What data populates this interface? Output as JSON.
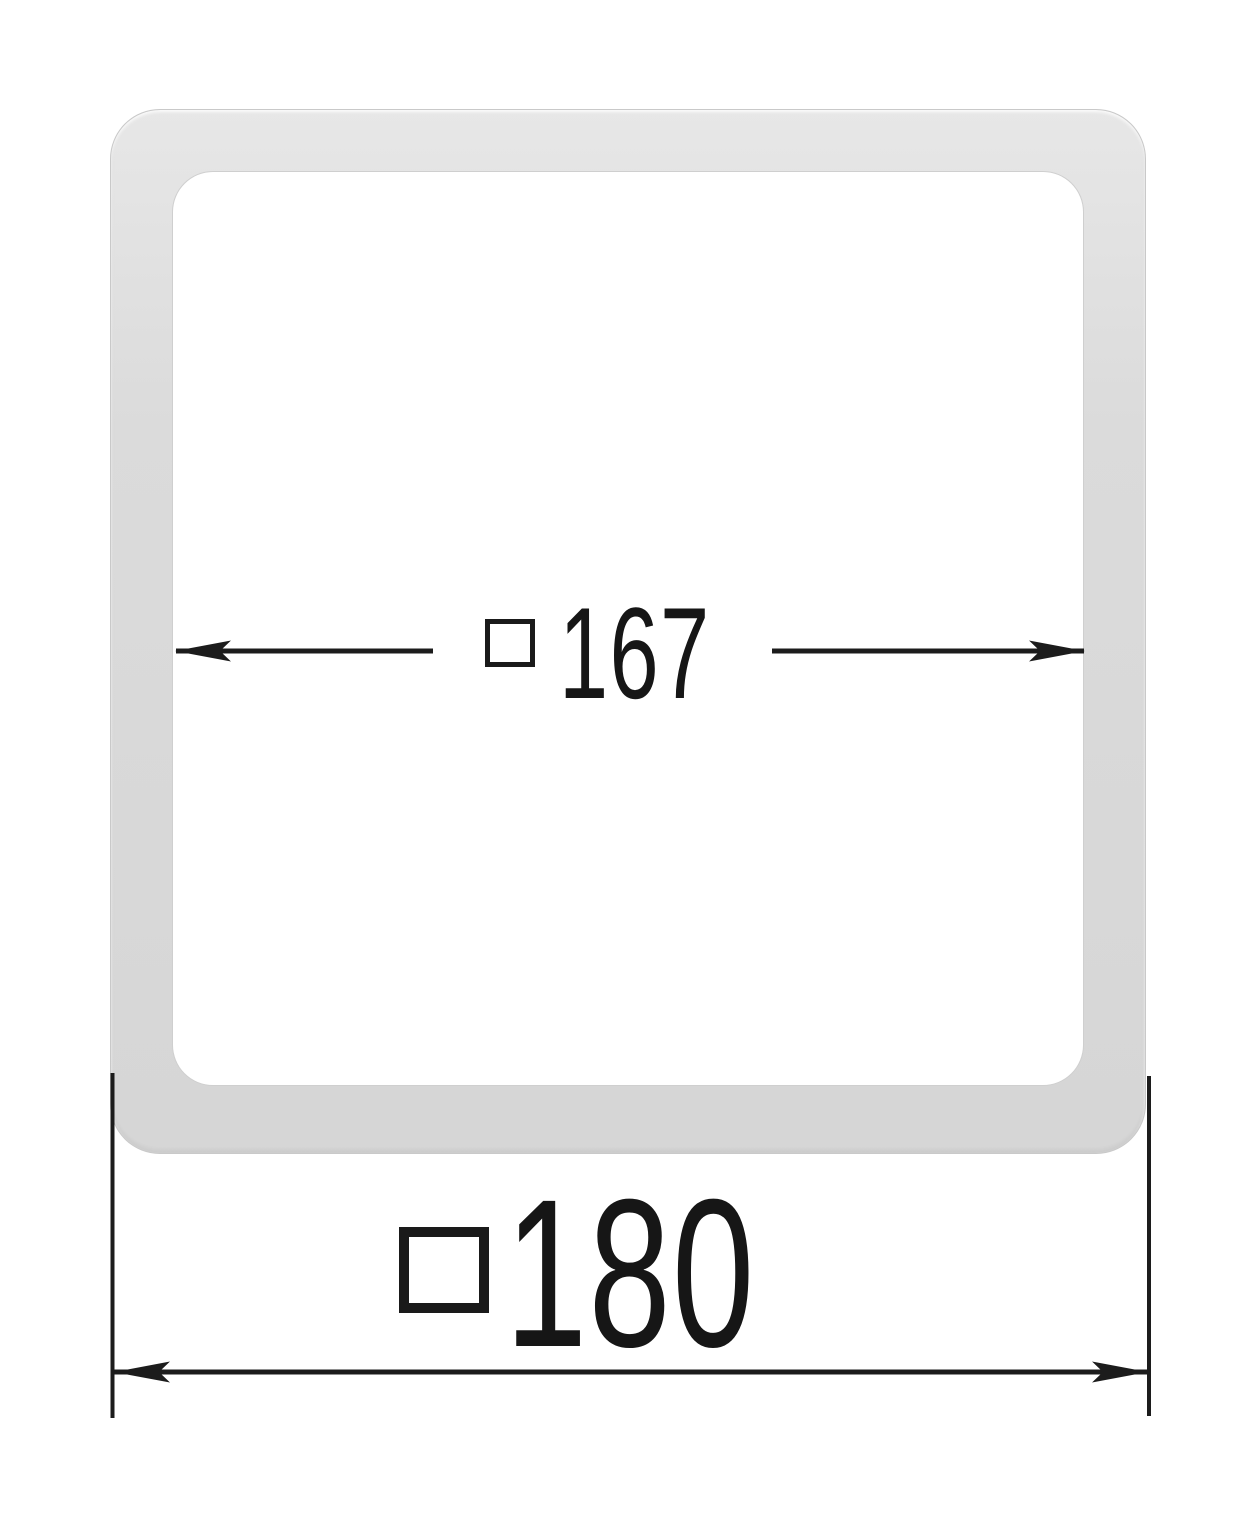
{
  "diagram": {
    "kind": "square-profile-cross-section",
    "inner_dimension": {
      "symbol": "□",
      "value": "167"
    },
    "outer_dimension": {
      "symbol": "□",
      "value": "180"
    }
  },
  "icons": {
    "square_symbol": "□ drawn as open square outline"
  },
  "colors": {
    "background": "#ffffff",
    "frame_fill": "#dbdbdb",
    "frame_edge": "#c9c9c9",
    "annotation_line": "#1c1c1c",
    "text": "#161616"
  }
}
